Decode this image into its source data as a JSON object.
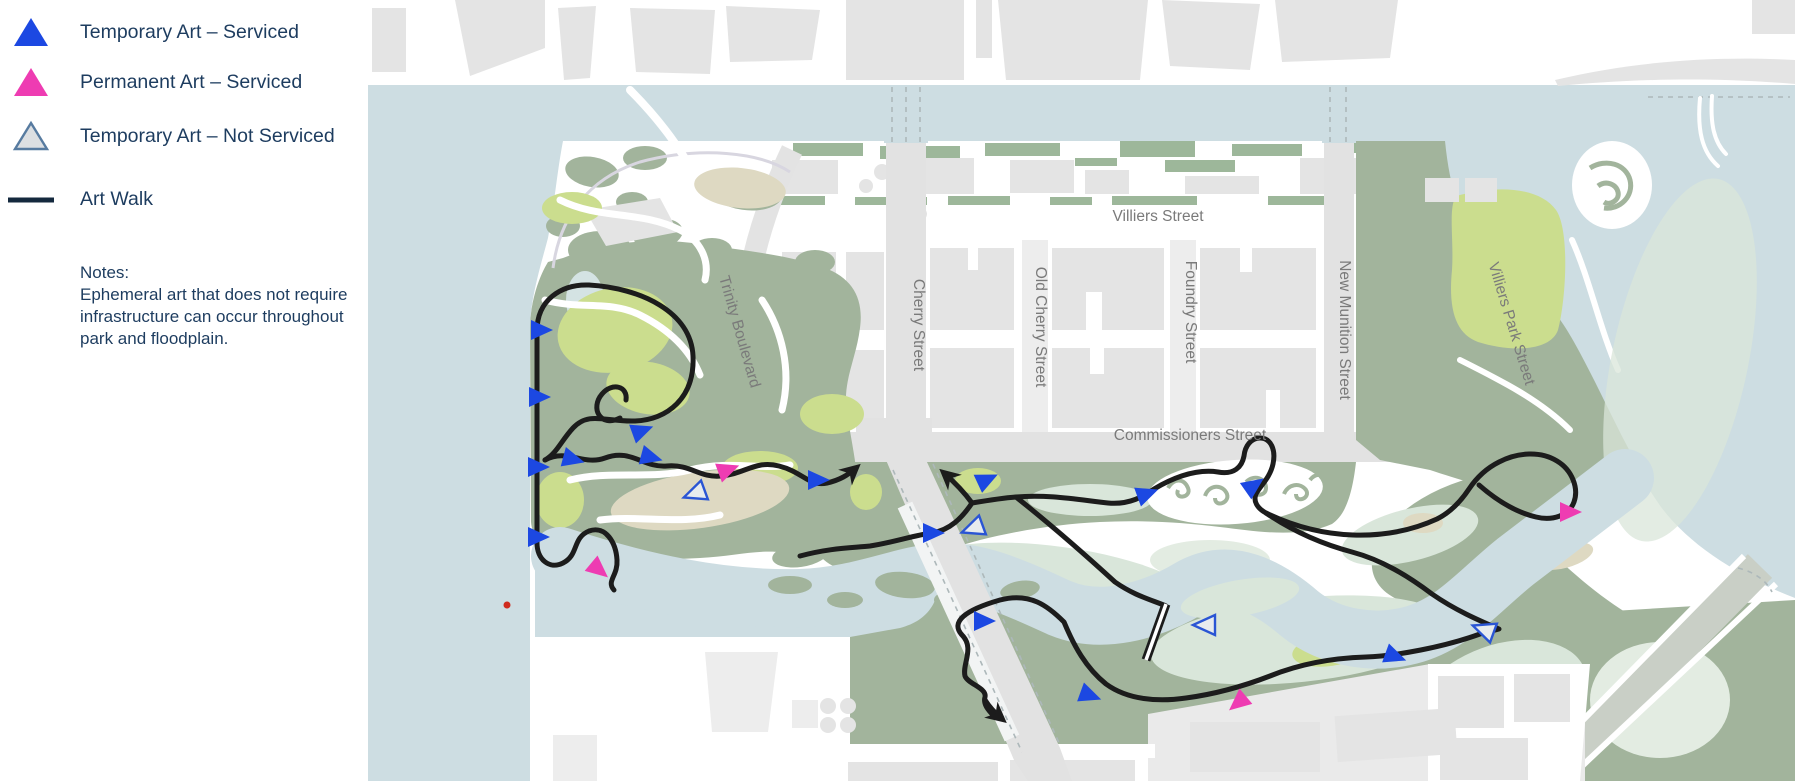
{
  "legend": {
    "items": [
      {
        "id": "temporary-serviced",
        "label": "Temporary Art – Serviced",
        "swatch": "triangle-blue-icon"
      },
      {
        "id": "permanent-serviced",
        "label": "Permanent Art – Serviced",
        "swatch": "triangle-pink-icon"
      },
      {
        "id": "temporary-not-serviced",
        "label": "Temporary Art – Not Serviced",
        "swatch": "triangle-outline-icon"
      },
      {
        "id": "art-walk",
        "label": "Art Walk",
        "swatch": "line-icon"
      }
    ],
    "notes_title": "Notes:",
    "notes_body": "Ephemeral art that does not require infrastructure can occur throughout park and floodplain."
  },
  "map": {
    "streets": [
      {
        "name": "Villiers Street",
        "x": 1158,
        "y": 221,
        "rot": 0
      },
      {
        "name": "Commissioners Street",
        "x": 1190,
        "y": 440,
        "rot": 0
      },
      {
        "name": "Cherry Street",
        "x": 914,
        "y": 325,
        "rot": 90
      },
      {
        "name": "Old Cherry Street",
        "x": 1036,
        "y": 327,
        "rot": 90
      },
      {
        "name": "Foundry Street",
        "x": 1186,
        "y": 312,
        "rot": 90
      },
      {
        "name": "New Munition Street",
        "x": 1340,
        "y": 330,
        "rot": 90
      },
      {
        "name": "Villiers Park Street",
        "x": 1507,
        "y": 325,
        "rot": 73
      },
      {
        "name": "Trinity Boulevard",
        "x": 735,
        "y": 333,
        "rot": 74
      }
    ],
    "markers": [
      {
        "type": "temporary-serviced",
        "x": 540,
        "y": 330,
        "rot": 0
      },
      {
        "type": "temporary-serviced",
        "x": 538,
        "y": 397,
        "rot": 0
      },
      {
        "type": "temporary-serviced",
        "x": 537,
        "y": 467,
        "rot": 0
      },
      {
        "type": "temporary-serviced",
        "x": 537,
        "y": 537,
        "rot": 0
      },
      {
        "type": "temporary-serviced",
        "x": 572,
        "y": 459,
        "rot": 15
      },
      {
        "type": "temporary-serviced",
        "x": 641,
        "y": 431,
        "rot": -20
      },
      {
        "type": "temporary-serviced",
        "x": 650,
        "y": 457,
        "rot": 15
      },
      {
        "type": "temporary-serviced",
        "x": 817,
        "y": 480,
        "rot": 0
      },
      {
        "type": "temporary-serviced",
        "x": 932,
        "y": 533,
        "rot": 0
      },
      {
        "type": "temporary-serviced",
        "x": 986,
        "y": 480,
        "rot": -25
      },
      {
        "type": "temporary-serviced",
        "x": 983,
        "y": 621,
        "rot": 0
      },
      {
        "type": "temporary-serviced",
        "x": 1089,
        "y": 695,
        "rot": 20
      },
      {
        "type": "temporary-serviced",
        "x": 1146,
        "y": 494,
        "rot": -20
      },
      {
        "type": "temporary-serviced",
        "x": 1253,
        "y": 486,
        "rot": -35
      },
      {
        "type": "temporary-serviced",
        "x": 1394,
        "y": 656,
        "rot": 20
      },
      {
        "type": "permanent-serviced",
        "x": 727,
        "y": 470,
        "rot": -20
      },
      {
        "type": "permanent-serviced",
        "x": 598,
        "y": 569,
        "rot": 40
      },
      {
        "type": "permanent-serviced",
        "x": 1239,
        "y": 702,
        "rot": 140
      },
      {
        "type": "permanent-serviced",
        "x": 1569,
        "y": 512,
        "rot": 0
      },
      {
        "type": "temporary-not-serviced",
        "x": 696,
        "y": 493,
        "rot": 160
      },
      {
        "type": "temporary-not-serviced",
        "x": 974,
        "y": 528,
        "rot": 160
      },
      {
        "type": "temporary-not-serviced",
        "x": 1206,
        "y": 625,
        "rot": 180
      },
      {
        "type": "temporary-not-serviced",
        "x": 1485,
        "y": 630,
        "rot": 200
      }
    ],
    "red_dot": {
      "x": 507,
      "y": 605
    }
  }
}
